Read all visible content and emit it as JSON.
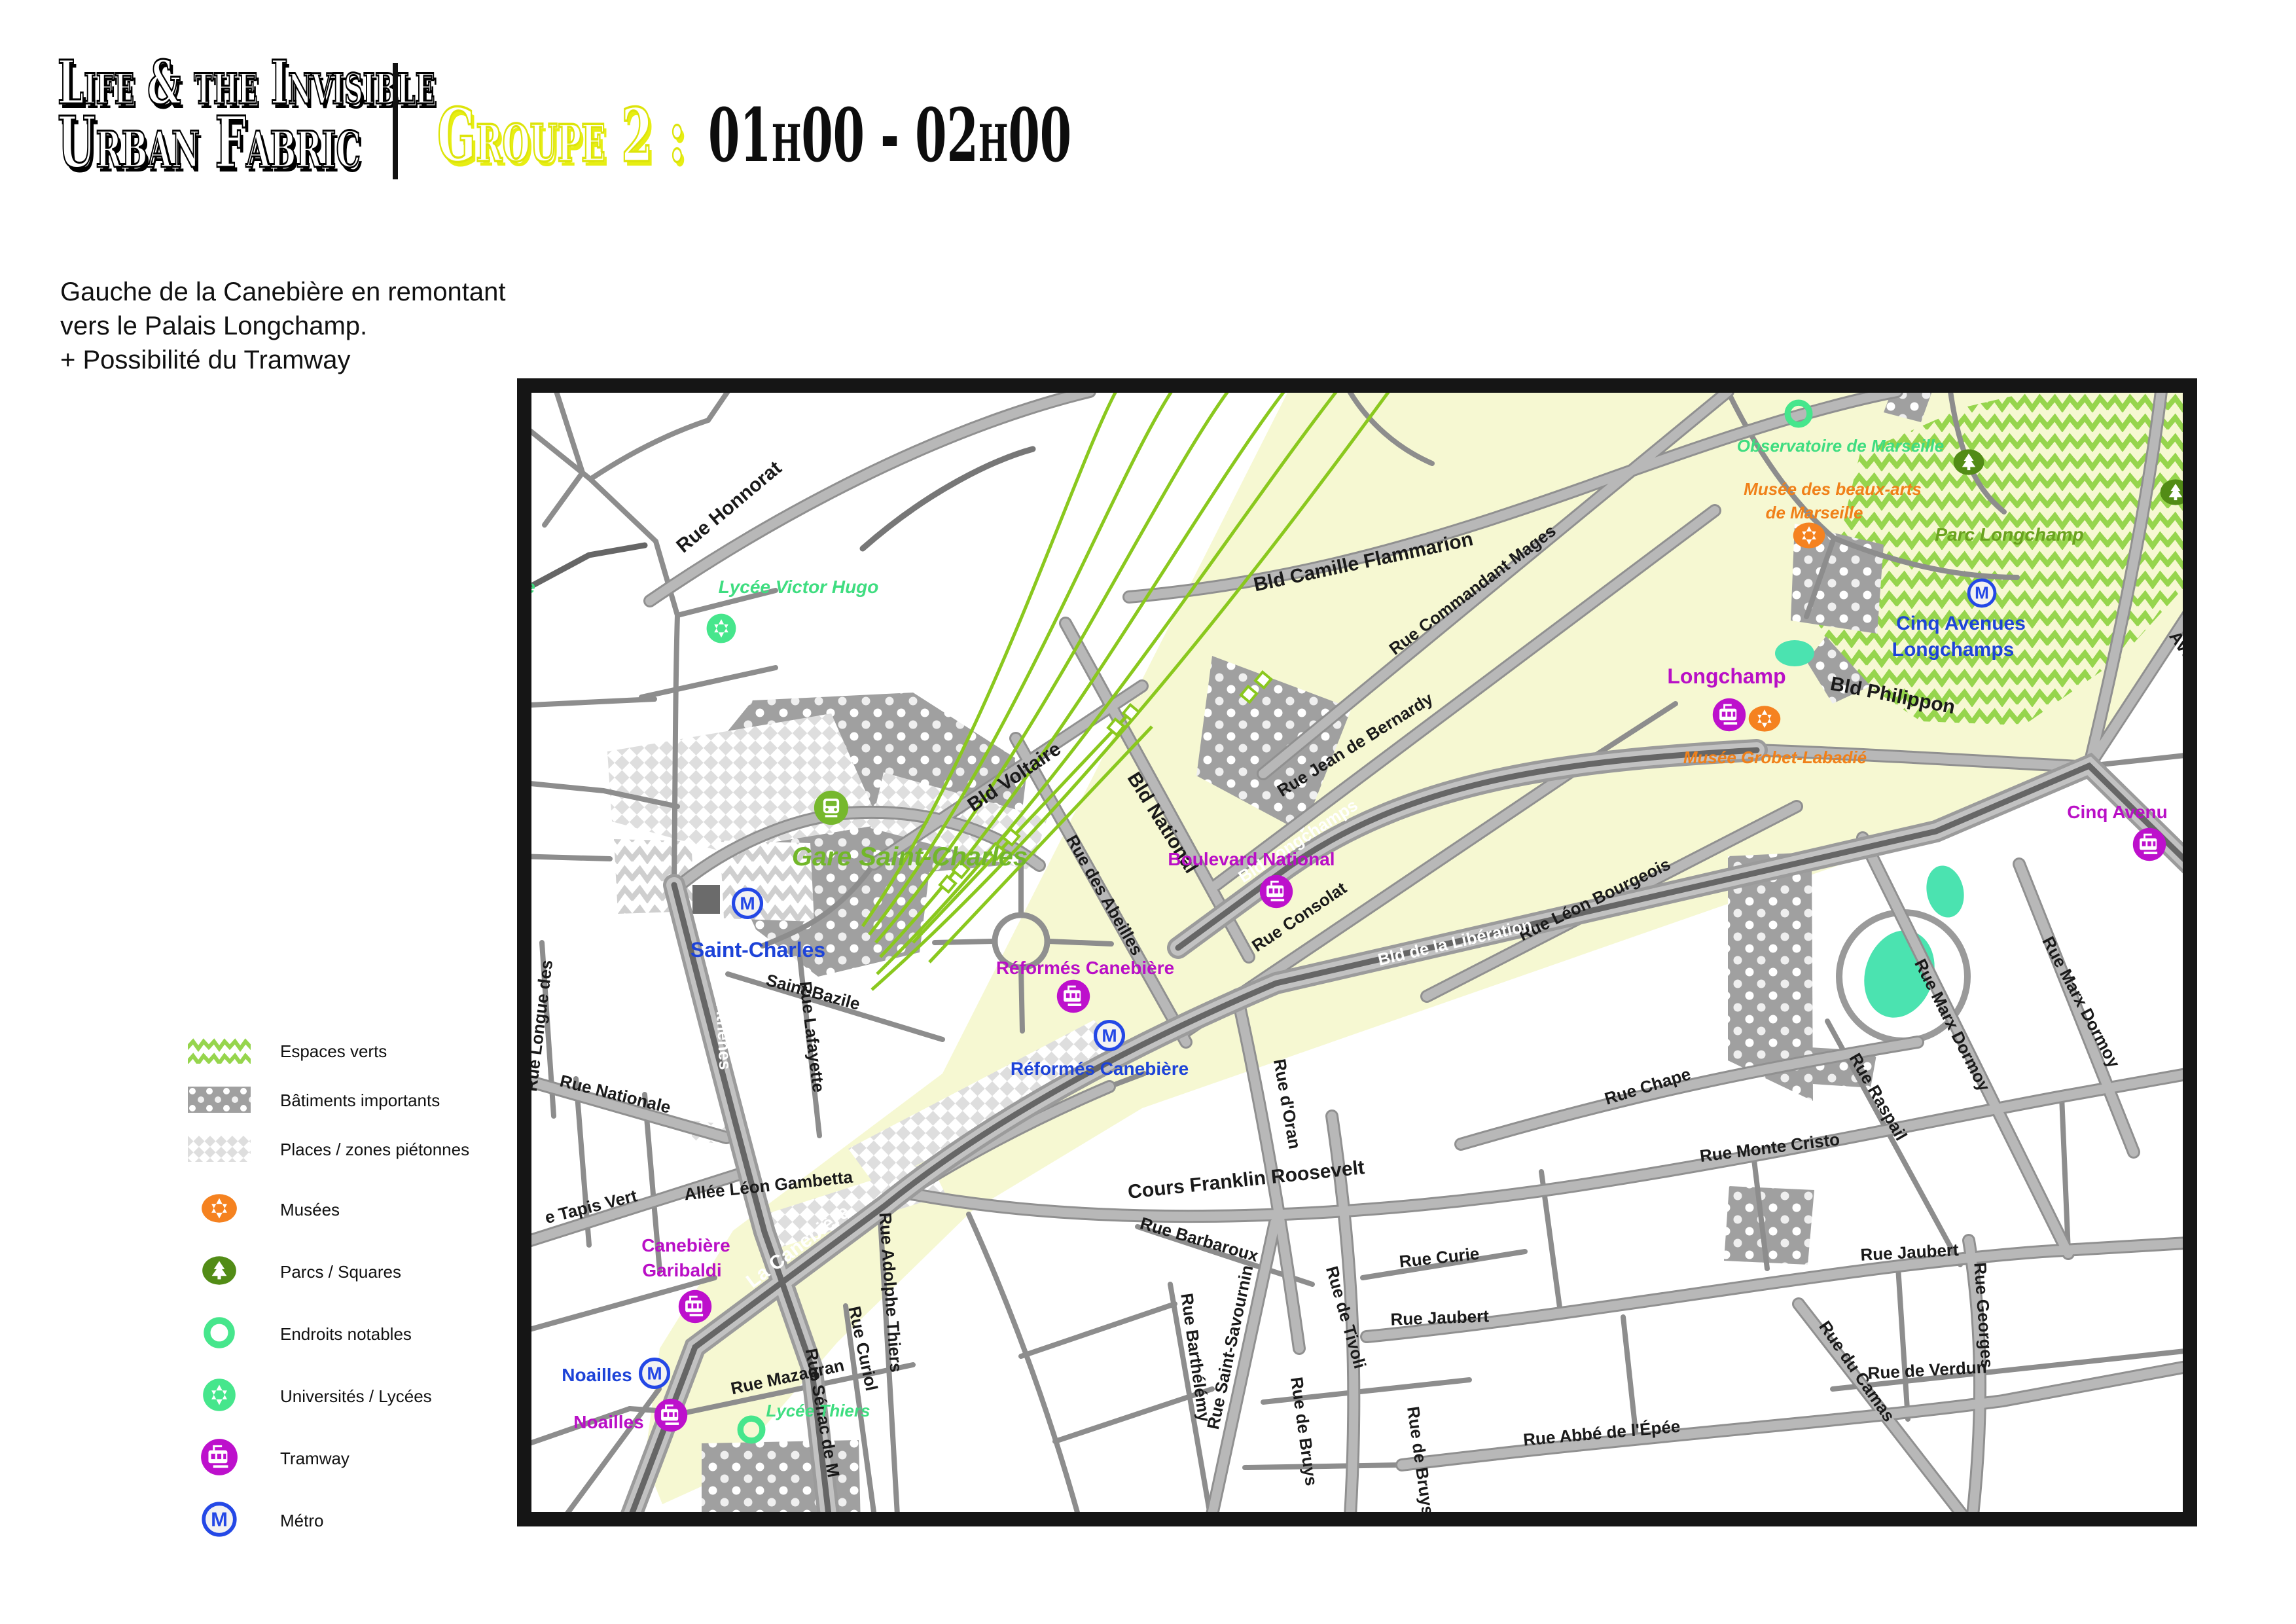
{
  "header": {
    "title_line1": "Life & the Invisible",
    "title_line2": "Urban Fabric",
    "group_label": "Groupe 2 :",
    "time_range": "01h00 - 02h00",
    "description_lines": [
      "Gauche de la Canebière en remontant",
      "vers le Palais Longchamp.",
      "+ Possibilité du Tramway"
    ]
  },
  "legend": {
    "items": [
      {
        "id": "espaces-verts",
        "label": "Espaces verts"
      },
      {
        "id": "batiments-importants",
        "label": "Bâtiments importants"
      },
      {
        "id": "places-zones-pietonnes",
        "label": "Places / zones piétonnes"
      },
      {
        "id": "musees",
        "label": "Musées"
      },
      {
        "id": "parcs-squares",
        "label": "Parcs / Squares"
      },
      {
        "id": "endroits-notables",
        "label": "Endroits notables"
      },
      {
        "id": "universites-lycees",
        "label": "Universités / Lycées"
      },
      {
        "id": "tramway",
        "label": "Tramway"
      },
      {
        "id": "metro",
        "label": "Métro"
      }
    ]
  },
  "icons": {
    "metro_letter": "M"
  },
  "map": {
    "streets": [
      {
        "name": "rue-honnorat",
        "label": "Rue Honnorat"
      },
      {
        "name": "bld-camille-flammarion",
        "label": "Bld Camille Flammarion"
      },
      {
        "name": "rue-commandant-mages",
        "label": "Rue Commandant Mages"
      },
      {
        "name": "rue-jean-de-bernardy",
        "label": "Rue Jean de Bernardy"
      },
      {
        "name": "bld-voltaire",
        "label": "Bld Voltaire"
      },
      {
        "name": "bld-national",
        "label": "Bld National"
      },
      {
        "name": "rue-des-abeilles",
        "label": "Rue des Abeilles"
      },
      {
        "name": "rue-consolat",
        "label": "Rue Consolat"
      },
      {
        "name": "rue-leon-bourgeois",
        "label": "Rue Léon Bourgeois"
      },
      {
        "name": "bld-philippon",
        "label": "Bld Philippon"
      },
      {
        "name": "saint-bazile",
        "label": "Saint-Bazile"
      },
      {
        "name": "rue-lafayette",
        "label": "Rue Lafayette"
      },
      {
        "name": "rue-longue-des",
        "label": "Rue Longue des"
      },
      {
        "name": "rue-nationale",
        "label": "Rue Nationale"
      },
      {
        "name": "tapis-vert",
        "label": "e Tapis Vert"
      },
      {
        "name": "allee-leon-gambetta",
        "label": "Allée Léon Gambetta"
      },
      {
        "name": "cours-franklin-roosevelt",
        "label": "Cours Franklin Roosevelt"
      },
      {
        "name": "rue-barbaroux",
        "label": "Rue Barbaroux"
      },
      {
        "name": "rue-barthelemy",
        "label": "Rue Barthélémy"
      },
      {
        "name": "rue-saint-savournin",
        "label": "Rue Saint-Savournin"
      },
      {
        "name": "rue-mazagran",
        "label": "Rue Mazagran"
      },
      {
        "name": "rue-senac",
        "label": "Rue Sénac de M"
      },
      {
        "name": "rue-curiol",
        "label": "Rue Curiol"
      },
      {
        "name": "rue-adolphe-thiers",
        "label": "Rue Adolphe Thiers"
      },
      {
        "name": "rue-d-oran",
        "label": "Rue d'Oran"
      },
      {
        "name": "rue-de-tivoli",
        "label": "Rue de Tivoli"
      },
      {
        "name": "rue-de-bruys",
        "label": "Rue de Bruys"
      },
      {
        "name": "rue-curie",
        "label": "Rue Curie"
      },
      {
        "name": "rue-jaubert",
        "label": "Rue  Jaubert"
      },
      {
        "name": "rue-abbe-de-l-epee",
        "label": "Rue Abbé de l'Épée"
      },
      {
        "name": "rue-monte-cristo",
        "label": "Rue  Monte Cristo"
      },
      {
        "name": "rue-de-verdun",
        "label": "Rue de Verdun"
      },
      {
        "name": "rue-du-camas",
        "label": "Rue du Camas"
      },
      {
        "name": "rue-georges",
        "label": "Rue Georges"
      },
      {
        "name": "rue-marx-dormoy",
        "label": "Rue Marx Dormoy"
      },
      {
        "name": "rue-raspail",
        "label": "Rue Raspail"
      },
      {
        "name": "rue-chape",
        "label": "Rue Chape"
      },
      {
        "name": "avenue",
        "label": "Avenue"
      }
    ],
    "roads_white": [
      {
        "name": "bld-d-athenes",
        "label": "Bld d'Athènes"
      },
      {
        "name": "la-canebiere",
        "label": "La Canebière"
      },
      {
        "name": "bld-longchamps",
        "label": "Bld Longchamps"
      },
      {
        "name": "bld-de-la-liberation",
        "label": "Bld de la Libération"
      }
    ],
    "pois": {
      "gare": {
        "label": "Gare Saint-Charles"
      },
      "metro": [
        {
          "label": "Saint-Charles"
        },
        {
          "label": "Réformés Canebière"
        },
        {
          "label": "Noailles"
        },
        {
          "line1": "Cinq Avenues",
          "line2": "Longchamps"
        }
      ],
      "tram": [
        {
          "label": "Longchamp"
        },
        {
          "label": "Boulevard National"
        },
        {
          "label": "Réformés Canebière"
        },
        {
          "line1": "Canebière",
          "line2": "Garibaldi"
        },
        {
          "label": "Noailles"
        },
        {
          "label": "Cinq Avenu"
        }
      ],
      "museums": [
        {
          "line1": "Musée des beaux-arts",
          "line2": "de Marseille"
        },
        {
          "label": "Musée Grobet-Labadié"
        }
      ],
      "parks": [
        {
          "label": "Parc Longchamp"
        }
      ],
      "notable": [
        {
          "label": "Observatoire de Marseille"
        }
      ],
      "schools": [
        {
          "label": "Lycée Victor Hugo"
        },
        {
          "label": "Lycée Thiers"
        },
        {
          "label": "le"
        }
      ]
    }
  },
  "colors": {
    "accent_yellow": "#e7ee12",
    "zone_yellow": "#f6f8d2",
    "tram_magenta": "#bd10cc",
    "metro_blue": "#2448e6",
    "museum_orange": "#f58220",
    "notable_mint": "#46e68c",
    "park_green": "#528c16",
    "railway_green": "#8ac81e",
    "road_gray": "#adadad",
    "artery_dark": "#666666"
  }
}
